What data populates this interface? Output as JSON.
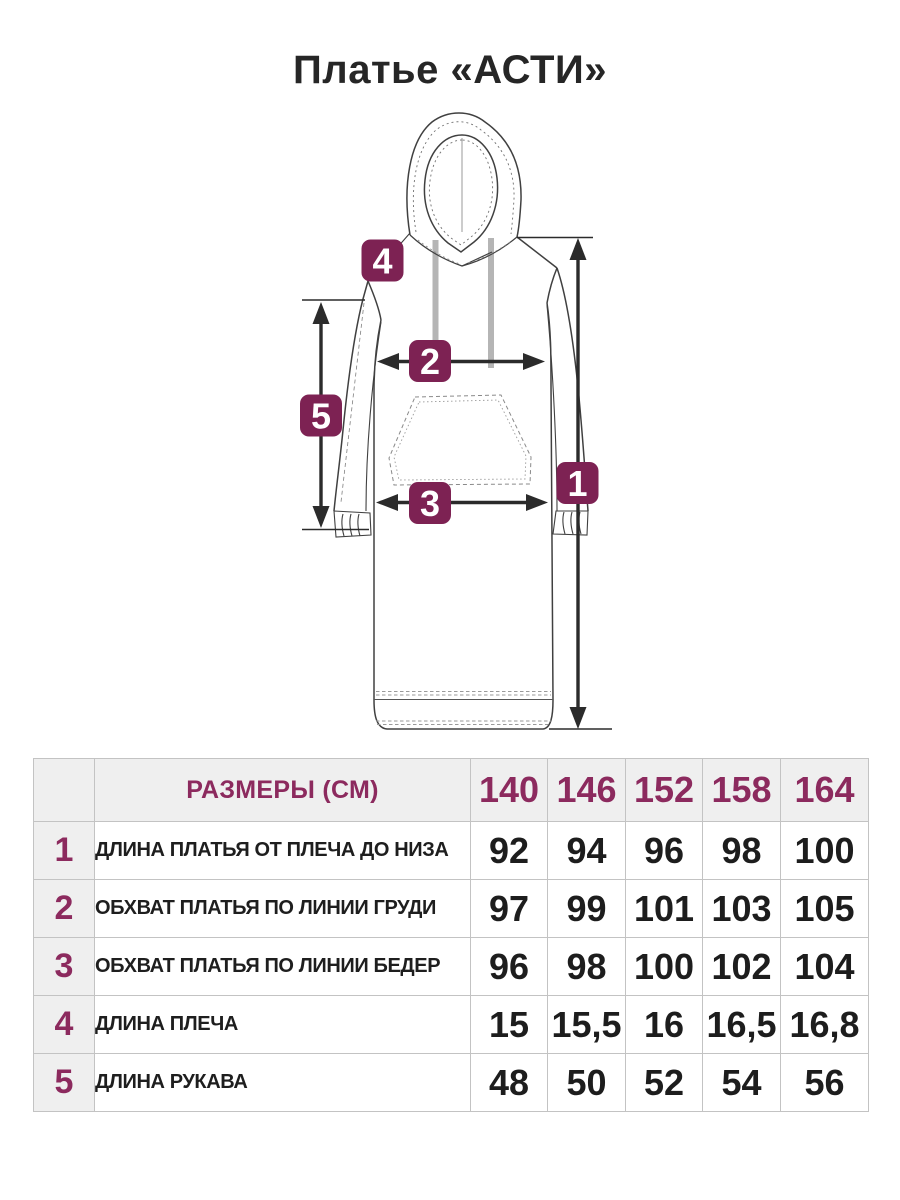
{
  "title": "Платье «АСТИ»",
  "colors": {
    "marker_fill": "#7d2253",
    "table_accent": "#8c2a5e",
    "title_text": "#262626",
    "value_text": "#1d1d1d",
    "table_border": "#c3c3c3",
    "table_header_bg": "#efefef",
    "sketch_line": "#404040",
    "stitch_line": "#8a8a8a",
    "drawstring": "#b5b5b5",
    "arrow": "#2b2b2b"
  },
  "diagram": {
    "garment": "hooded-dress-flat-sketch",
    "markers": [
      {
        "label": "1"
      },
      {
        "label": "2"
      },
      {
        "label": "3"
      },
      {
        "label": "4"
      },
      {
        "label": "5"
      }
    ]
  },
  "table": {
    "header": {
      "label": "РАЗМЕРЫ (СМ)",
      "sizes": [
        "140",
        "146",
        "152",
        "158",
        "164"
      ]
    },
    "rows": [
      {
        "num": "1",
        "label": "ДЛИНА ПЛАТЬЯ ОТ ПЛЕЧА ДО НИЗА",
        "values": [
          "92",
          "94",
          "96",
          "98",
          "100"
        ]
      },
      {
        "num": "2",
        "label": "ОБХВАТ ПЛАТЬЯ ПО ЛИНИИ ГРУДИ",
        "values": [
          "97",
          "99",
          "101",
          "103",
          "105"
        ]
      },
      {
        "num": "3",
        "label": "ОБХВАТ ПЛАТЬЯ ПО ЛИНИИ БЕДЕР",
        "values": [
          "96",
          "98",
          "100",
          "102",
          "104"
        ]
      },
      {
        "num": "4",
        "label": "ДЛИНА ПЛЕЧА",
        "values": [
          "15",
          "15,5",
          "16",
          "16,5",
          "16,8"
        ]
      },
      {
        "num": "5",
        "label": "ДЛИНА РУКАВА",
        "values": [
          "48",
          "50",
          "52",
          "54",
          "56"
        ]
      }
    ]
  }
}
